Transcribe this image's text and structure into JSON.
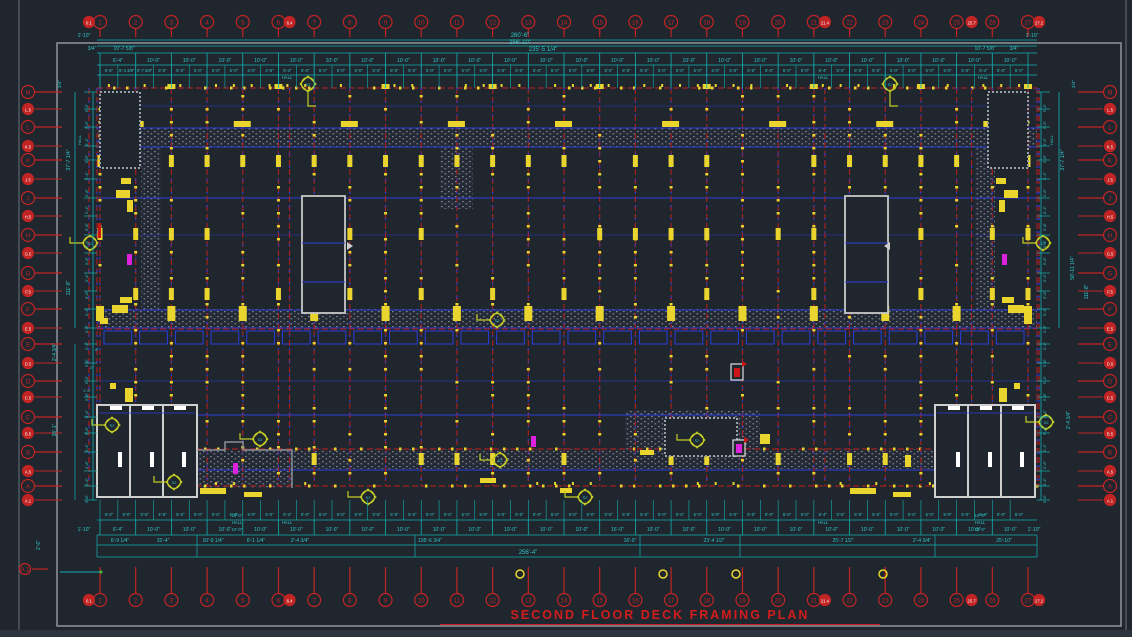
{
  "sheet": {
    "title": "SECOND FLOOR DECK FRAMING PLAN"
  },
  "colors": {
    "bg": "#20262e",
    "bg2": "#232935",
    "frame": "#8f969e",
    "red": "#c22424",
    "dash_red": "#a32020",
    "blue": "#2c3ddb",
    "yellow": "#e9d52e",
    "teal": "#12b0b0",
    "teal_text": "#2cc9c9",
    "magenta": "#dd22dd",
    "white": "#d9d9d9",
    "hatch": "#7d838c",
    "marker": "#c3cc25",
    "title": "#d11d1d"
  },
  "grid": {
    "cols_major": [
      "1",
      "2",
      "3",
      "4",
      "5",
      "6",
      "7",
      "8",
      "9",
      "10",
      "11",
      "12",
      "13",
      "14",
      "15",
      "16",
      "17",
      "18",
      "19",
      "20",
      "21",
      "22",
      "23",
      "24",
      "25",
      "26",
      "27"
    ],
    "cols_minor": [
      {
        "label": "0.1",
        "idx": -0.31
      },
      {
        "label": "6.4",
        "idx": 5.31
      },
      {
        "label": "21.4",
        "idx": 20.31
      },
      {
        "label": "25.7",
        "idx": 24.42
      },
      {
        "label": "27.2",
        "idx": 26.31
      }
    ],
    "rows_major": [
      "M",
      "L",
      "K",
      "J",
      "H",
      "G",
      "F",
      "E",
      "D",
      "C",
      "B",
      "A"
    ],
    "rows_minor": [
      "L.5",
      "K.5",
      "J.5",
      "H.5",
      "G.5",
      "F.5",
      "E.5",
      "D.5",
      "C.5",
      "B.5",
      "A.5",
      "A.1"
    ],
    "datum_label": "A.1"
  },
  "dims": {
    "overall_top": [
      "260'-6\"",
      "256'-10\"",
      "235'-5 1/4\""
    ],
    "overall_bottom": "256'-4\"",
    "corner_top_left": [
      "1'-10\"",
      "3/4\"",
      "10'-7 5/8\""
    ],
    "corner_top_right": [
      "10'-7 5/8\"",
      "3/4\"",
      "1'-10\""
    ],
    "corner_side": "3/4\"",
    "bay_label": "10'-0\"",
    "half_label": "5'-0\"",
    "hall": "HALL",
    "bay_specials_top": {
      "0": "6'-4\""
    },
    "half_specials_top": {
      "0": "6'-6\"",
      "1": "6'-4 3/8\"",
      "2": "5'-7 5/8\"",
      "9": "4'-6\"",
      "10": "5'-4\"",
      "40": "5'-4\"",
      "49": "5'-4\""
    },
    "bay_specials_bottom": {
      "0": "6'-4\"",
      "14": "16'-0\"",
      "24": "10'-5\""
    },
    "half_specials_bottom": {
      "0": "5'-3\"",
      "3": "4'-5\"",
      "10": "5'-4\"",
      "40": "5'-4\"",
      "49": "5'-4\""
    },
    "hall_top_x": [
      287,
      823,
      983
    ],
    "hall_bottom_x": [
      287,
      823
    ],
    "stair_stack": [
      "10'-0\"",
      "HALL",
      "10'-0\""
    ],
    "edge_bottom_left": "1'-10\"",
    "edge_bottom_right": "1'-10\"",
    "bottom_row3": [
      {
        "x": 120,
        "t": "6'-9 1/4\""
      },
      {
        "x": 163,
        "t": "15'-4\""
      },
      {
        "x": 213,
        "t": "10'-9 1/4\""
      },
      {
        "x": 256,
        "t": "6'-1 1/4\""
      },
      {
        "x": 300,
        "t": "2'-4 3/4\""
      },
      {
        "x": 430,
        "t": "105'-6 3/4\""
      },
      {
        "x": 630,
        "t": "16'-0\""
      },
      {
        "x": 714,
        "t": "23'-4 1/2\""
      },
      {
        "x": 843,
        "t": "25'-7 1/2\""
      },
      {
        "x": 922,
        "t": "2'-4 3/4\""
      },
      {
        "x": 1004,
        "t": "25'-10\""
      }
    ],
    "left_big": [
      {
        "y": 160,
        "t": "37'-7 1/4\""
      },
      {
        "y": 288,
        "t": "111'-8\""
      },
      {
        "y": 352,
        "t": "2'-4 3/4\""
      },
      {
        "y": 430,
        "t": "36'-1\""
      },
      {
        "y": 545,
        "t": "2'-6\""
      }
    ],
    "right_big": [
      {
        "y": 160,
        "t": "37'-7 1/4\""
      },
      {
        "y": 268,
        "t": "58'-11 1/4\""
      },
      {
        "y": 292,
        "t": "111'-8\""
      },
      {
        "y": 420,
        "t": "2'-4 3/4\""
      }
    ],
    "side_small_a": "5'-4\"",
    "side_small_b": "5'-8\"",
    "side_hall_left_y": 140,
    "side_hall_right_y": 140,
    "misc_left": [
      {
        "x": 97,
        "y": 351,
        "t": "8\""
      },
      {
        "x": 92,
        "y": 369,
        "t": "2\""
      },
      {
        "x": 87,
        "y": 392,
        "t": "1'-5\""
      }
    ],
    "marker_label": "S2"
  }
}
